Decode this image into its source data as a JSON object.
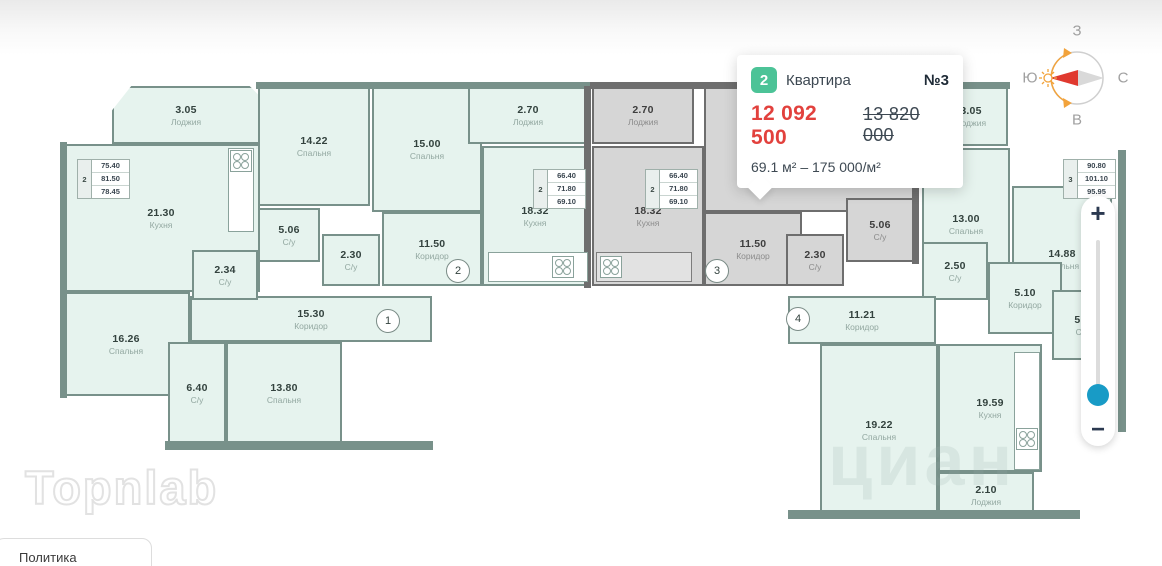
{
  "colors": {
    "badge_green": "#4cc397",
    "price_red": "#e2413d",
    "handle_blue": "#189bc6",
    "mint_fill": "#e6f3ee",
    "mint_wall": "#78918a",
    "gray_fill": "#d6d6d6",
    "gray_wall": "#6e6e6e"
  },
  "tooltip": {
    "badge": "2",
    "type_label": "Квартира",
    "number_label": "№3",
    "price": "12 092 500",
    "old_price": "13 820 000",
    "area_line": "69.1 м² – 175 000/м²"
  },
  "compass": {
    "top": "З",
    "left": "Ю",
    "right": "С",
    "bottom": "В"
  },
  "zoom_control": {
    "plus_label": "+",
    "minus_label": "−"
  },
  "watermark": {
    "logo": "Topnlab",
    "cian": "циан"
  },
  "footer": {
    "policy_label": "Политика"
  },
  "floorplan": {
    "rooms": [
      {
        "area": "3.05",
        "name": "Лоджия",
        "x": 112,
        "y": 86,
        "w": 148,
        "h": 58,
        "cut": true
      },
      {
        "area": "21.30",
        "name": "Кухня",
        "x": 62,
        "y": 144,
        "w": 198,
        "h": 148
      },
      {
        "area": "16.26",
        "name": "Спальня",
        "x": 62,
        "y": 292,
        "w": 128,
        "h": 104
      },
      {
        "area": "15.30",
        "name": "Коридор",
        "x": 190,
        "y": 296,
        "w": 242,
        "h": 46
      },
      {
        "area": "2.34",
        "name": "С/у",
        "x": 192,
        "y": 250,
        "w": 66,
        "h": 50
      },
      {
        "area": "6.40",
        "name": "С/у",
        "x": 168,
        "y": 342,
        "w": 58,
        "h": 102
      },
      {
        "area": "13.80",
        "name": "Спальня",
        "x": 226,
        "y": 342,
        "w": 116,
        "h": 102
      },
      {
        "area": "14.22",
        "name": "Спальня",
        "x": 258,
        "y": 86,
        "w": 112,
        "h": 120
      },
      {
        "area": "15.00",
        "name": "Спальня",
        "x": 372,
        "y": 86,
        "w": 110,
        "h": 126
      },
      {
        "area": "2.70",
        "name": "Лоджия",
        "x": 468,
        "y": 86,
        "w": 120,
        "h": 58
      },
      {
        "area": "18.32",
        "name": "Кухня",
        "x": 482,
        "y": 146,
        "w": 106,
        "h": 140
      },
      {
        "area": "5.06",
        "name": "С/у",
        "x": 258,
        "y": 208,
        "w": 62,
        "h": 54
      },
      {
        "area": "2.30",
        "name": "С/у",
        "x": 322,
        "y": 234,
        "w": 58,
        "h": 52
      },
      {
        "area": "11.50",
        "name": "Коридор",
        "x": 382,
        "y": 212,
        "w": 100,
        "h": 74
      },
      {
        "variant": "gray",
        "x": 704,
        "y": 86,
        "w": 210,
        "h": 126
      },
      {
        "area": "2.70",
        "name": "Лоджия",
        "x": 592,
        "y": 86,
        "w": 102,
        "h": 58,
        "variant": "gray"
      },
      {
        "area": "18.32",
        "name": "Кухня",
        "x": 592,
        "y": 146,
        "w": 112,
        "h": 140,
        "variant": "gray"
      },
      {
        "area": "11.50",
        "name": "Коридор",
        "x": 704,
        "y": 212,
        "w": 98,
        "h": 74,
        "variant": "gray"
      },
      {
        "area": "2.30",
        "name": "С/у",
        "x": 786,
        "y": 234,
        "w": 58,
        "h": 52,
        "variant": "gray"
      },
      {
        "area": "5.06",
        "name": "С/у",
        "x": 846,
        "y": 198,
        "w": 68,
        "h": 64,
        "variant": "gray"
      },
      {
        "area": "3.05",
        "name": "Лоджия",
        "x": 934,
        "y": 86,
        "w": 74,
        "h": 60
      },
      {
        "area": "13.00",
        "name": "Спальня",
        "x": 922,
        "y": 148,
        "w": 88,
        "h": 152
      },
      {
        "area": "14.88",
        "name": "Спальня",
        "x": 1012,
        "y": 186,
        "w": 100,
        "h": 146
      },
      {
        "area": "2.50",
        "name": "С/у",
        "x": 922,
        "y": 242,
        "w": 66,
        "h": 58
      },
      {
        "area": "5.10",
        "name": "Коридор",
        "x": 988,
        "y": 262,
        "w": 74,
        "h": 72
      },
      {
        "area": "5.3",
        "name": "С/у",
        "x": 1052,
        "y": 290,
        "w": 60,
        "h": 70
      },
      {
        "area": "11.21",
        "name": "Коридор",
        "x": 788,
        "y": 296,
        "w": 148,
        "h": 48
      },
      {
        "area": "19.22",
        "name": "Спальня",
        "x": 820,
        "y": 344,
        "w": 118,
        "h": 172
      },
      {
        "area": "19.59",
        "name": "Кухня",
        "x": 938,
        "y": 344,
        "w": 104,
        "h": 128
      },
      {
        "area": "2.10",
        "name": "Лоджия",
        "x": 938,
        "y": 472,
        "w": 96,
        "h": 46
      }
    ],
    "walls": [
      {
        "x": 256,
        "y": 82,
        "w": 336,
        "h": 7
      },
      {
        "x": 590,
        "y": 82,
        "w": 330,
        "h": 7,
        "variant": "gray"
      },
      {
        "x": 918,
        "y": 82,
        "w": 92,
        "h": 7
      },
      {
        "x": 60,
        "y": 142,
        "w": 7,
        "h": 256
      },
      {
        "x": 584,
        "y": 86,
        "w": 7,
        "h": 202,
        "variant": "gray"
      },
      {
        "x": 912,
        "y": 86,
        "w": 7,
        "h": 178,
        "variant": "gray"
      },
      {
        "x": 165,
        "y": 441,
        "w": 268,
        "h": 9
      },
      {
        "x": 788,
        "y": 510,
        "w": 292,
        "h": 9
      },
      {
        "x": 1118,
        "y": 150,
        "w": 8,
        "h": 282
      }
    ],
    "counters": [
      {
        "x": 228,
        "y": 148,
        "w": 26,
        "h": 84
      },
      {
        "x": 488,
        "y": 252,
        "w": 100,
        "h": 30
      },
      {
        "x": 596,
        "y": 252,
        "w": 96,
        "h": 30,
        "variant": "gray"
      },
      {
        "x": 1014,
        "y": 352,
        "w": 26,
        "h": 118
      }
    ],
    "stoves": [
      {
        "x": 230,
        "y": 150,
        "s": 22
      },
      {
        "x": 552,
        "y": 256,
        "s": 22
      },
      {
        "x": 600,
        "y": 256,
        "s": 22,
        "variant": "gray"
      },
      {
        "x": 1016,
        "y": 428,
        "s": 22
      }
    ],
    "tables": [
      {
        "num": "2",
        "values": [
          "75.40",
          "81.50",
          "78.45"
        ],
        "x": 78,
        "y": 160
      },
      {
        "num": "2",
        "values": [
          "66.40",
          "71.80",
          "69.10"
        ],
        "x": 534,
        "y": 170
      },
      {
        "num": "2",
        "values": [
          "66.40",
          "71.80",
          "69.10"
        ],
        "x": 646,
        "y": 170
      },
      {
        "num": "3",
        "values": [
          "90.80",
          "101.10",
          "95.95"
        ],
        "x": 1064,
        "y": 160
      }
    ],
    "markers": [
      {
        "label": "1",
        "x": 388,
        "y": 321
      },
      {
        "label": "2",
        "x": 458,
        "y": 271
      },
      {
        "label": "3",
        "x": 717,
        "y": 271
      },
      {
        "label": "4",
        "x": 798,
        "y": 319
      }
    ]
  }
}
